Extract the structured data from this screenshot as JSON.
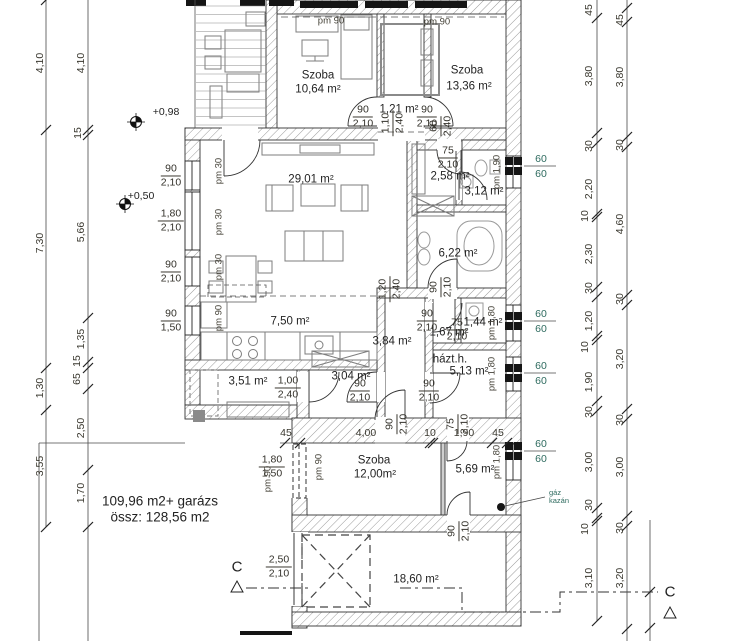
{
  "summary": {
    "line1": "109,96 m2+ garázs",
    "line2": "össz: 128,56 m2"
  },
  "section": {
    "letter": "C"
  },
  "boiler": {
    "line1": "gáz",
    "line2": "kazán"
  },
  "colors": {
    "ink": "#1f1f1f",
    "dim_text": "#3a382f",
    "teal": "#2e6b5f",
    "hatch": "#9a9a9a",
    "furniture": "#7d7d7d"
  },
  "rooms": [
    {
      "t": "Szoba",
      "x": 318,
      "y": 76
    },
    {
      "t": "10,64 m²",
      "x": 318,
      "y": 90
    },
    {
      "t": "Szoba",
      "x": 467,
      "y": 71
    },
    {
      "t": "13,36 m²",
      "x": 469,
      "y": 87
    },
    {
      "t": "1,21 m²",
      "x": 399,
      "y": 110
    },
    {
      "t": "29,01 m²",
      "x": 311,
      "y": 180
    },
    {
      "t": "2,58 m²",
      "x": 450,
      "y": 177
    },
    {
      "t": "3,12 m²",
      "x": 484,
      "y": 192
    },
    {
      "t": "6,22 m²",
      "x": 458,
      "y": 254
    },
    {
      "t": "7,50 m²",
      "x": 290,
      "y": 322
    },
    {
      "t": "3,84 m²",
      "x": 392,
      "y": 342
    },
    {
      "t": "1,44 m²",
      "x": 483,
      "y": 323
    },
    {
      "t": "1,67 m²",
      "x": 449,
      "y": 333
    },
    {
      "t": "házt.h.",
      "x": 450,
      "y": 360
    },
    {
      "t": "5,13 m²",
      "x": 469,
      "y": 372
    },
    {
      "t": "3,51 m²",
      "x": 248,
      "y": 382
    },
    {
      "t": "3,04 m²",
      "x": 351,
      "y": 377
    },
    {
      "t": "Szoba",
      "x": 374,
      "y": 461
    },
    {
      "t": "12,00m²",
      "x": 375,
      "y": 475
    },
    {
      "t": "5,69 m²",
      "x": 475,
      "y": 470
    },
    {
      "t": "18,60 m²",
      "x": 416,
      "y": 580
    }
  ],
  "dims": [
    {
      "t": "4,10",
      "x": 40,
      "y": 63,
      "r": -90
    },
    {
      "t": "7,30",
      "x": 40,
      "y": 243,
      "r": -90
    },
    {
      "t": "1,30",
      "x": 40,
      "y": 388,
      "r": -90
    },
    {
      "t": "3,55",
      "x": 40,
      "y": 466,
      "r": -90
    },
    {
      "t": "4,10",
      "x": 81,
      "y": 63,
      "r": -90
    },
    {
      "t": "15",
      "x": 78,
      "y": 133,
      "r": -90
    },
    {
      "t": "5,66",
      "x": 81,
      "y": 232,
      "r": -90
    },
    {
      "t": "1,35",
      "x": 81,
      "y": 339,
      "r": -90
    },
    {
      "t": "15",
      "x": 77,
      "y": 361,
      "r": -90
    },
    {
      "t": "65",
      "x": 77,
      "y": 379,
      "r": -90
    },
    {
      "t": "2,50",
      "x": 81,
      "y": 428,
      "r": -90
    },
    {
      "t": "1,70",
      "x": 81,
      "y": 493,
      "r": -90
    },
    {
      "t": "45",
      "x": 589,
      "y": 10,
      "r": -90
    },
    {
      "t": "3,80",
      "x": 589,
      "y": 76,
      "r": -90
    },
    {
      "t": "30",
      "x": 589,
      "y": 146,
      "r": -90
    },
    {
      "t": "2,20",
      "x": 589,
      "y": 189,
      "r": -90
    },
    {
      "t": "10",
      "x": 585,
      "y": 216,
      "r": -90
    },
    {
      "t": "2,30",
      "x": 589,
      "y": 254,
      "r": -90
    },
    {
      "t": "30",
      "x": 589,
      "y": 288,
      "r": -90
    },
    {
      "t": "1,20",
      "x": 589,
      "y": 321,
      "r": -90
    },
    {
      "t": "10",
      "x": 585,
      "y": 347,
      "r": -90
    },
    {
      "t": "1,90",
      "x": 589,
      "y": 382,
      "r": -90
    },
    {
      "t": "30",
      "x": 589,
      "y": 412,
      "r": -90
    },
    {
      "t": "3,00",
      "x": 589,
      "y": 462,
      "r": -90
    },
    {
      "t": "30",
      "x": 589,
      "y": 505,
      "r": -90
    },
    {
      "t": "10",
      "x": 585,
      "y": 529,
      "r": -90
    },
    {
      "t": "3,10",
      "x": 589,
      "y": 578,
      "r": -90
    },
    {
      "t": "45",
      "x": 620,
      "y": 20,
      "r": -90
    },
    {
      "t": "3,80",
      "x": 620,
      "y": 77,
      "r": -90
    },
    {
      "t": "30",
      "x": 620,
      "y": 145,
      "r": -90
    },
    {
      "t": "4,60",
      "x": 620,
      "y": 224,
      "r": -90
    },
    {
      "t": "30",
      "x": 620,
      "y": 299,
      "r": -90
    },
    {
      "t": "3,20",
      "x": 620,
      "y": 359,
      "r": -90
    },
    {
      "t": "30",
      "x": 620,
      "y": 420,
      "r": -90
    },
    {
      "t": "3,00",
      "x": 620,
      "y": 467,
      "r": -90
    },
    {
      "t": "30",
      "x": 620,
      "y": 528,
      "r": -90
    },
    {
      "t": "3,20",
      "x": 620,
      "y": 578,
      "r": -90
    },
    {
      "t": "45",
      "x": 286,
      "y": 433
    },
    {
      "t": "4,00",
      "x": 366,
      "y": 433
    },
    {
      "t": "10",
      "x": 430,
      "y": 433
    },
    {
      "t": "1,90",
      "x": 464,
      "y": 433
    },
    {
      "t": "45",
      "x": 498,
      "y": 433
    }
  ],
  "fracs": [
    {
      "a": "90",
      "b": "2,10",
      "x": 171,
      "y": 176
    },
    {
      "a": "1,80",
      "b": "2,10",
      "x": 171,
      "y": 221
    },
    {
      "a": "90",
      "b": "2,10",
      "x": 171,
      "y": 272
    },
    {
      "a": "90",
      "b": "1,50",
      "x": 171,
      "y": 321
    },
    {
      "a": "90",
      "b": "2,10",
      "x": 363,
      "y": 117
    },
    {
      "a": "90",
      "b": "2,10",
      "x": 427,
      "y": 117
    },
    {
      "a": "75",
      "b": "2,10",
      "x": 448,
      "y": 158
    },
    {
      "a": "90",
      "b": "2,10",
      "x": 427,
      "y": 321
    },
    {
      "a": "75",
      "b": "2,10",
      "x": 457,
      "y": 330
    },
    {
      "a": "90",
      "b": "2,10",
      "x": 360,
      "y": 391
    },
    {
      "a": "90",
      "b": "2,10",
      "x": 429,
      "y": 391
    },
    {
      "a": "1,00",
      "b": "2,40",
      "x": 288,
      "y": 388
    },
    {
      "a": "1,80",
      "b": "1,50",
      "x": 272,
      "y": 467
    },
    {
      "a": "2,50",
      "b": "2,10",
      "x": 279,
      "y": 567
    },
    {
      "a": "1,10",
      "b": "2,40",
      "x": 393,
      "y": 123,
      "r": -90
    },
    {
      "a": "60",
      "b": "2,40",
      "x": 441,
      "y": 126,
      "r": -90
    },
    {
      "a": "1,20",
      "b": "2,40",
      "x": 390,
      "y": 289,
      "r": -90
    },
    {
      "a": "90",
      "b": "2,10",
      "x": 441,
      "y": 287,
      "r": -90
    },
    {
      "a": "90",
      "b": "2,10",
      "x": 397,
      "y": 424,
      "r": -90
    },
    {
      "a": "75",
      "b": "2,10",
      "x": 458,
      "y": 424,
      "r": -90
    },
    {
      "a": "90",
      "b": "2,10",
      "x": 459,
      "y": 531,
      "r": -90
    }
  ],
  "pm": [
    {
      "t": "pm 90",
      "x": 331,
      "y": 21
    },
    {
      "t": "pm 90",
      "x": 437,
      "y": 22
    },
    {
      "t": "pm 30",
      "x": 219,
      "y": 171,
      "r": -90
    },
    {
      "t": "pm 30",
      "x": 219,
      "y": 222,
      "r": -90
    },
    {
      "t": "pm 30",
      "x": 219,
      "y": 267,
      "r": -90
    },
    {
      "t": "pm 90",
      "x": 219,
      "y": 318,
      "r": -90
    },
    {
      "t": "pm 1,90",
      "x": 497,
      "y": 172,
      "r": -90
    },
    {
      "t": "pm 1,80",
      "x": 492,
      "y": 323,
      "r": -90
    },
    {
      "t": "pm 1,80",
      "x": 492,
      "y": 374,
      "r": -90
    },
    {
      "t": "pm 1,80",
      "x": 497,
      "y": 462,
      "r": -90
    },
    {
      "t": "pm 90",
      "x": 319,
      "y": 467,
      "r": -90
    },
    {
      "t": "pm 90",
      "x": 268,
      "y": 479,
      "r": -90
    }
  ],
  "levels": [
    {
      "t": "+0,98",
      "x": 166,
      "y": 112
    },
    {
      "t": "+0,50",
      "x": 141,
      "y": 196
    }
  ],
  "pillars": [
    {
      "a": "60",
      "b": "60",
      "x": 541,
      "y": 166
    },
    {
      "a": "60",
      "b": "60",
      "x": 541,
      "y": 321
    },
    {
      "a": "60",
      "b": "60",
      "x": 541,
      "y": 373
    },
    {
      "a": "60",
      "b": "60",
      "x": 541,
      "y": 451
    }
  ]
}
